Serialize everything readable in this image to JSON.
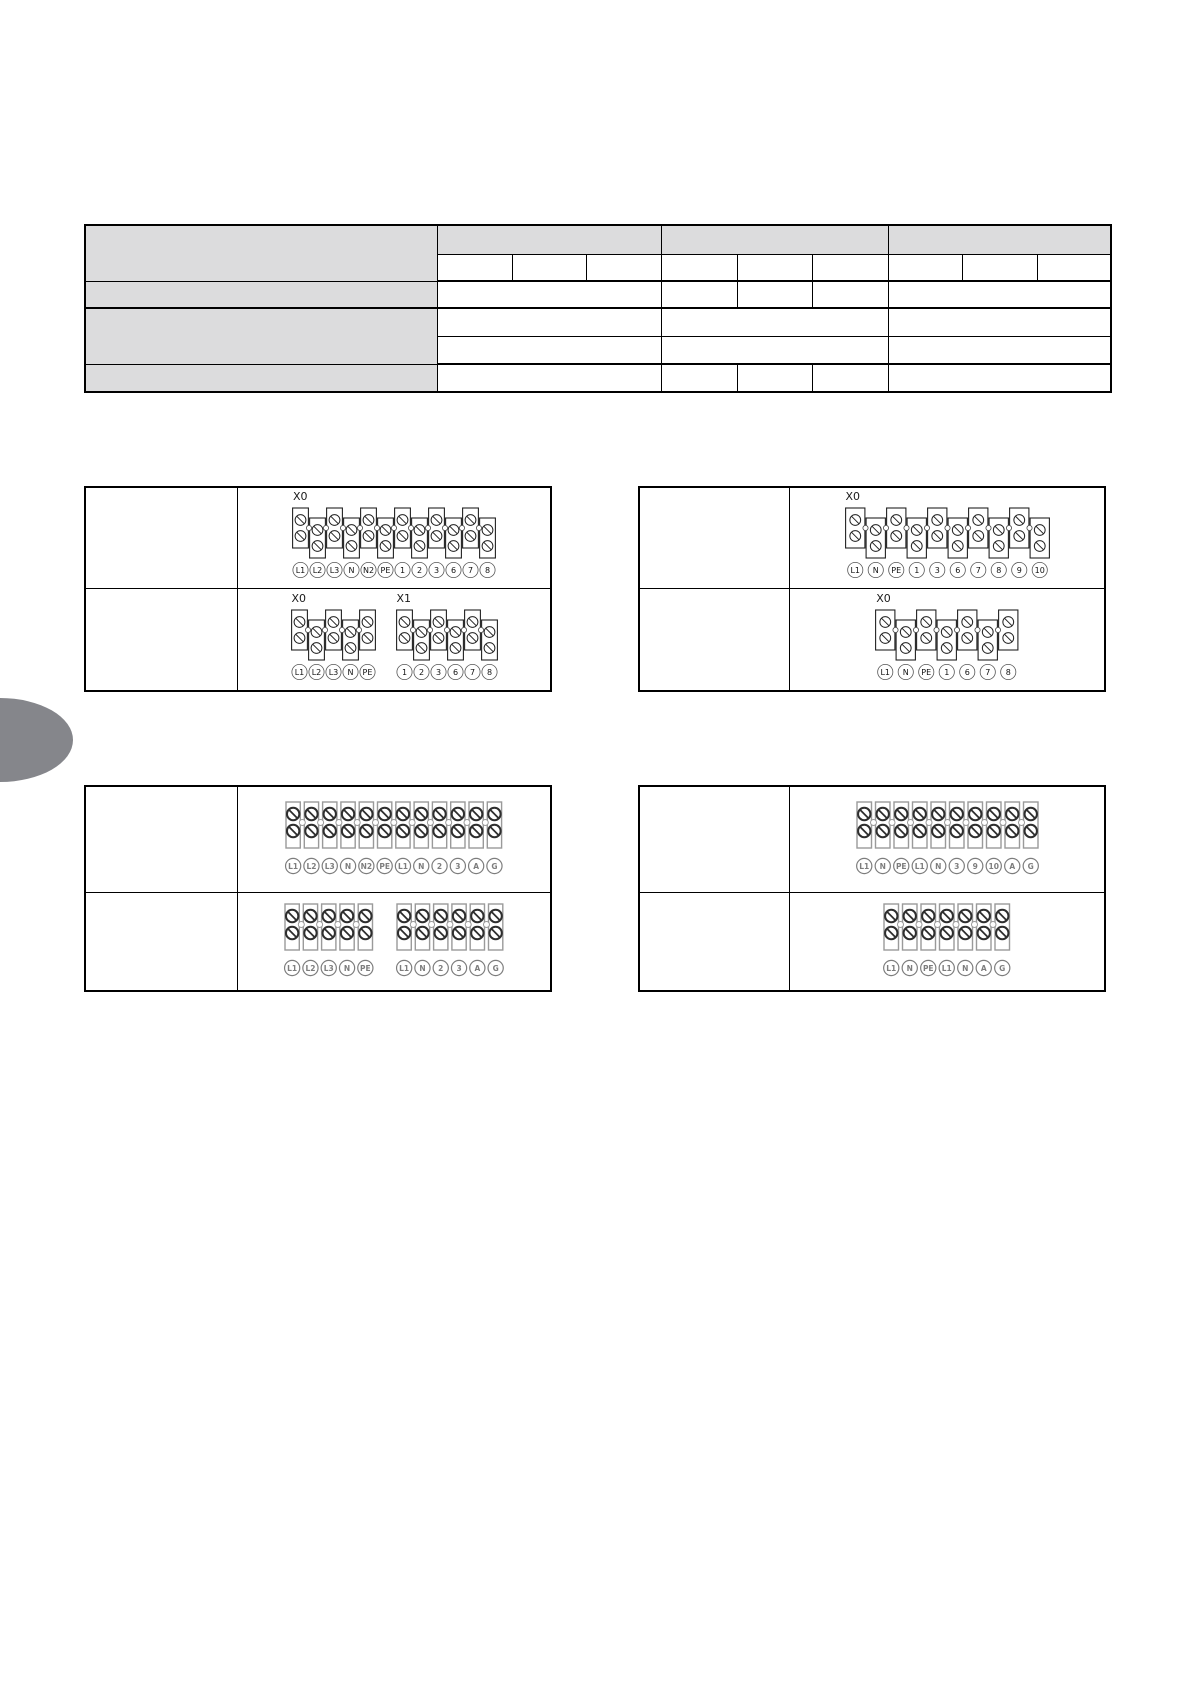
{
  "colors": {
    "table_header_bg": "#dcdcdd",
    "line": "#000000",
    "tab": "#85868b",
    "screw_dark": "#2e2e2e",
    "gray_outline": "#9a9a9a",
    "gray_label": "#7d7d7d"
  },
  "diagrams": {
    "top_left": {
      "rows": [
        {
          "strips": [
            {
              "designator": "X0",
              "labels": [
                "L1",
                "L2",
                "L3",
                "N",
                "N2",
                "PE",
                "1",
                "2",
                "3",
                "6",
                "7",
                "8"
              ]
            }
          ]
        },
        {
          "strips": [
            {
              "designator": "X0",
              "labels": [
                "L1",
                "L2",
                "L3",
                "N",
                "PE"
              ]
            },
            {
              "designator": "X1",
              "labels": [
                "1",
                "2",
                "3",
                "6",
                "7",
                "8"
              ]
            }
          ]
        }
      ]
    },
    "top_right": {
      "rows": [
        {
          "strips": [
            {
              "designator": "X0",
              "labels": [
                "L1",
                "N",
                "PE",
                "1",
                "3",
                "6",
                "7",
                "8",
                "9",
                "10"
              ]
            }
          ]
        },
        {
          "strips": [
            {
              "designator": "X0",
              "labels": [
                "L1",
                "N",
                "PE",
                "1",
                "6",
                "7",
                "8"
              ]
            }
          ]
        }
      ]
    },
    "bottom_left": {
      "rows": [
        {
          "strips": [
            {
              "designator": "",
              "labels": [
                "L1",
                "L2",
                "L3",
                "N",
                "N2",
                "PE",
                "L1",
                "N",
                "2",
                "3",
                "A",
                "G"
              ]
            }
          ]
        },
        {
          "strips": [
            {
              "designator": "",
              "labels": [
                "L1",
                "L2",
                "L3",
                "N",
                "PE"
              ]
            },
            {
              "designator": "",
              "labels": [
                "L1",
                "N",
                "2",
                "3",
                "A",
                "G"
              ]
            }
          ]
        }
      ]
    },
    "bottom_right": {
      "rows": [
        {
          "strips": [
            {
              "designator": "",
              "labels": [
                "L1",
                "N",
                "PE",
                "L1",
                "N",
                "3",
                "9",
                "10",
                "A",
                "G"
              ]
            }
          ]
        },
        {
          "strips": [
            {
              "designator": "",
              "labels": [
                "L1",
                "N",
                "PE",
                "L1",
                "N",
                "A",
                "G"
              ]
            }
          ]
        }
      ]
    }
  }
}
